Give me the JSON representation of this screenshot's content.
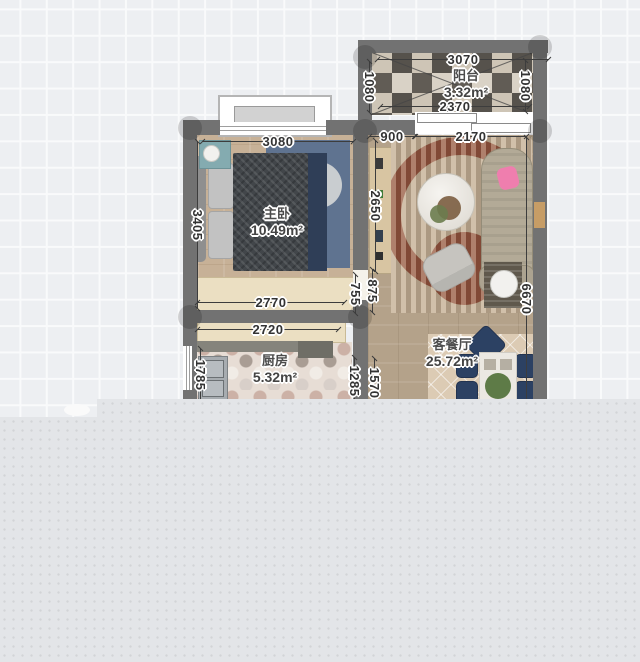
{
  "app": {
    "view": "floorplan-canvas",
    "canvas_colors": {
      "grid_bg": "#edeff2",
      "grid_line": "#f9fafb",
      "overlay_panel": "#e3e5e8",
      "wall": "#727272"
    }
  },
  "floorplan": {
    "rooms": [
      {
        "id": "balcony",
        "name": "阳台",
        "area": "3.32m²"
      },
      {
        "id": "master-bedroom",
        "name": "主卧",
        "area": "10.49m²"
      },
      {
        "id": "kitchen",
        "name": "厨房",
        "area": "5.32m²"
      },
      {
        "id": "living-dining",
        "name": "客餐厅",
        "area": "25.72m²"
      }
    ],
    "dimensions": [
      {
        "text": "3070",
        "o": "h",
        "x": 463,
        "y": 59,
        "len": 172
      },
      {
        "text": "2370",
        "o": "h",
        "x": 455,
        "y": 106,
        "len": 150
      },
      {
        "text": "1080",
        "o": "v",
        "x": 370,
        "y": 87,
        "len": 52
      },
      {
        "text": "1080",
        "o": "v",
        "x": 526,
        "y": 86,
        "len": 52
      },
      {
        "text": "3080",
        "o": "h",
        "x": 278,
        "y": 141,
        "len": 152
      },
      {
        "text": "900",
        "o": "h",
        "x": 392,
        "y": 136,
        "len": 46
      },
      {
        "text": "2170",
        "o": "h",
        "x": 471,
        "y": 136,
        "len": 112
      },
      {
        "text": "3405",
        "o": "v",
        "x": 198,
        "y": 225,
        "len": 168
      },
      {
        "text": "2650",
        "o": "v",
        "x": 376,
        "y": 206,
        "len": 132
      },
      {
        "text": "755",
        "o": "v",
        "x": 356,
        "y": 294,
        "len": 40
      },
      {
        "text": "875",
        "o": "v",
        "x": 373,
        "y": 291,
        "len": 44
      },
      {
        "text": "2770",
        "o": "h",
        "x": 271,
        "y": 302,
        "len": 148
      },
      {
        "text": "2720",
        "o": "h",
        "x": 268,
        "y": 329,
        "len": 142
      },
      {
        "text": "1785",
        "o": "v",
        "x": 201,
        "y": 375,
        "len": 54
      },
      {
        "text": "1285",
        "o": "v",
        "x": 355,
        "y": 381,
        "len": 48
      },
      {
        "text": "1570",
        "o": "v",
        "x": 375,
        "y": 383,
        "len": 50
      },
      {
        "text": "6670",
        "o": "v",
        "x": 527,
        "y": 299,
        "len": 324
      }
    ]
  }
}
